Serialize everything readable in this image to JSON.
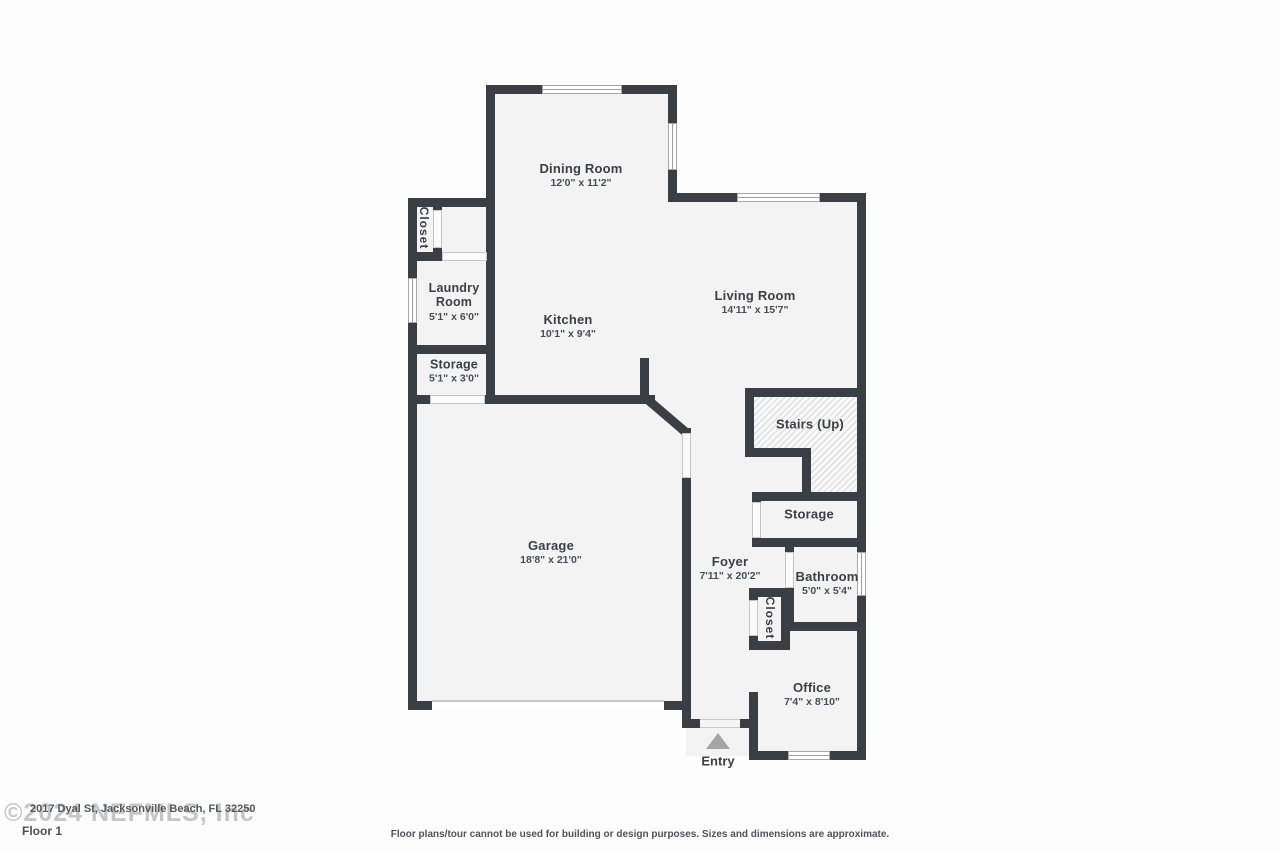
{
  "meta": {
    "watermark": "©2024 NEFMLS, Inc",
    "address": "2017 Dyal St, Jacksonville Beach, FL 32250",
    "floor_label": "Floor 1",
    "disclaimer": "Floor plans/tour cannot be used for building or design purposes. Sizes and dimensions are approximate."
  },
  "rooms": {
    "dining": {
      "name": "Dining Room",
      "dims": "12'0\" x 11'2\""
    },
    "living": {
      "name": "Living Room",
      "dims": "14'11\" x 15'7\""
    },
    "kitchen": {
      "name": "Kitchen",
      "dims": "10'1\" x 9'4\""
    },
    "laundry": {
      "name": "Laundry Room",
      "dims": "5'1\" x 6'0\""
    },
    "closet_upper": {
      "name": "Closet"
    },
    "storage_upper": {
      "name": "Storage",
      "dims": "5'1\" x 3'0\""
    },
    "garage": {
      "name": "Garage",
      "dims": "18'8\" x 21'0\""
    },
    "stairs": {
      "name": "Stairs (Up)"
    },
    "storage_lower": {
      "name": "Storage"
    },
    "foyer": {
      "name": "Foyer",
      "dims": "7'11\" x 20'2\""
    },
    "bathroom": {
      "name": "Bathroom",
      "dims": "5'0\" x 5'4\""
    },
    "closet_lower": {
      "name": "Closet"
    },
    "office": {
      "name": "Office",
      "dims": "7'4\" x 8'10\""
    }
  },
  "entry": {
    "label": "Entry"
  },
  "colors": {
    "wall": "#3a3e45",
    "floor": "#f3f3f4",
    "hatch_line": "#d9d9d9",
    "text": "#3b4047",
    "entry_arrow": "#a5a5a5"
  }
}
